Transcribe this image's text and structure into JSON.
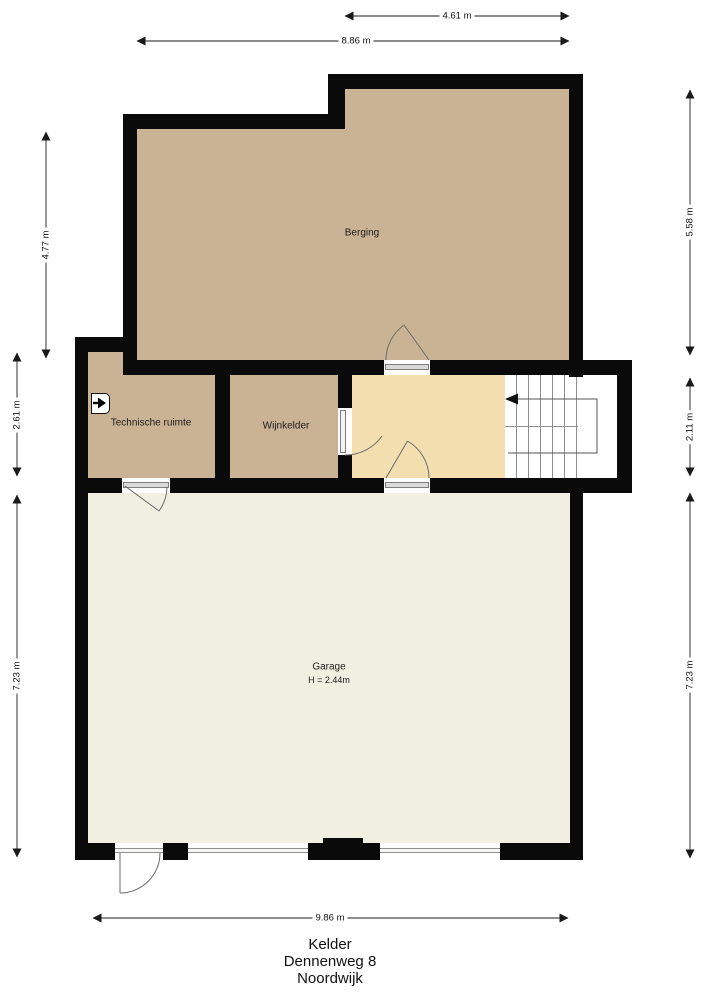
{
  "plan": {
    "rooms": {
      "berging": {
        "label": "Berging"
      },
      "technische_ruimte": {
        "label": "Technische ruimte"
      },
      "wijnkelder": {
        "label": "Wijnkelder"
      },
      "garage": {
        "label": "Garage",
        "height_note": "H = 2.44m"
      }
    },
    "dimensions": {
      "top_inner": "4.61 m",
      "top_outer": "8.86 m",
      "left_upper": "4.77 m",
      "left_middle": "2.61 m",
      "left_lower": "7.23 m",
      "right_upper": "5.58 m",
      "right_middle": "2.11 m",
      "right_lower": "7.23 m",
      "bottom": "9.86 m"
    },
    "footer": {
      "line1": "Kelder",
      "line2": "Dennenweg 8",
      "line3": "Noordwijk"
    },
    "icons": {
      "meter_cabinet": "meter-cabinet-icon",
      "stairs_arrow": "stairs-direction-arrow-icon"
    },
    "colors": {
      "wall": "#0a0a0a",
      "room_tan": "#cab394",
      "hall_cream": "#f3deaf",
      "garage_offwhite": "#f1efe2",
      "outline_gray": "#6b6b6b"
    }
  }
}
